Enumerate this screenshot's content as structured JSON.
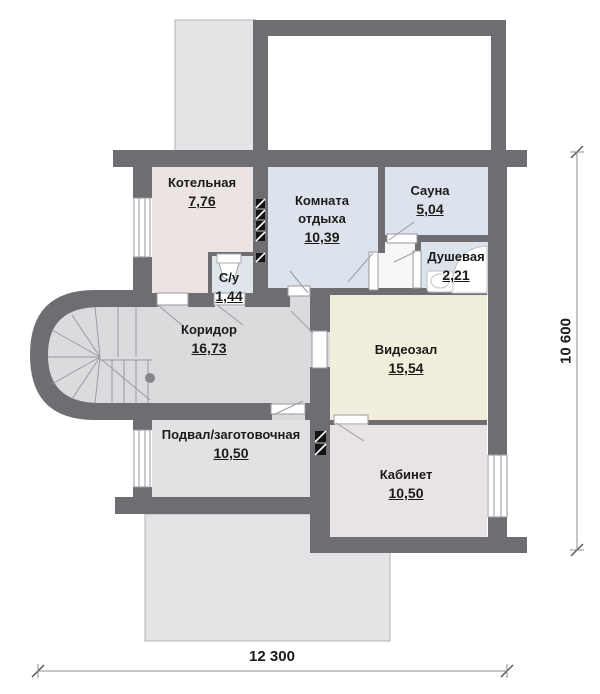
{
  "plan": {
    "title": "floor-plan",
    "rooms": [
      {
        "id": "kotelnaya",
        "name": "Котельная",
        "area": "7,76"
      },
      {
        "id": "komnata-otdyha",
        "name": "Комната",
        "name2": "отдыха",
        "area": "10,39"
      },
      {
        "id": "sauna",
        "name": "Сауна",
        "area": "5,04"
      },
      {
        "id": "dushevaya",
        "name": "Душевая",
        "area": "2,21"
      },
      {
        "id": "su",
        "name": "С/у",
        "area": "1,44"
      },
      {
        "id": "koridor",
        "name": "Коридор",
        "area": "16,73"
      },
      {
        "id": "videozal",
        "name": "Видеозал",
        "area": "15,54"
      },
      {
        "id": "podval",
        "name": "Подвал/заготовочная",
        "area": "10,50"
      },
      {
        "id": "kabinet",
        "name": "Кабинет",
        "area": "10,50"
      }
    ],
    "dimensions": {
      "width_label": "12 300",
      "height_label": "10 600"
    },
    "colors": {
      "wall": "#6d6d72",
      "room_pink": "#ebe4e2",
      "room_blue": "#dce3ec",
      "room_cream": "#f1efdc",
      "room_gray": "#dbdbdd",
      "room_podval": "#e2e2e4",
      "room_kabinet": "#e9e3e4",
      "terrace": "#e4e4e6",
      "text": "#1b1b1b"
    }
  }
}
